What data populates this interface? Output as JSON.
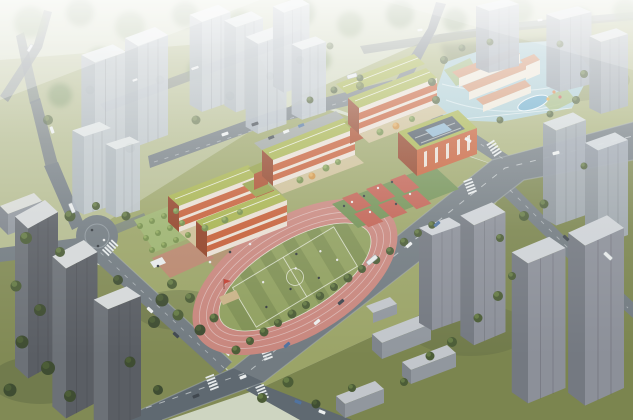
{
  "meta": {
    "title": "Aerial architectural rendering of a school campus surrounded by high-rise towers",
    "description": "Bird's-eye rendering: orange classroom wings with green roofs arranged in a zigzag, a gymnasium with a dark skylit roof, red basketball courts, an oval running track with a striped green pitch, a kindergarten parcel with blue play grounds at the upper right, diagonal roads with vehicles and crosswalks, and hazy grey residential towers around the site.",
    "visible_text": []
  },
  "colors": {
    "grass_haze": "#ccd2b5",
    "grass_pale": "#b4ba8c",
    "grass_base": "#99a262",
    "grass_mid": "#a7ae74",
    "grass_dark": "#7e864f",
    "grass_low": "#788148",
    "shadow_green": "#55613a",
    "road": "#6e777d",
    "road_dark": "#5a646c",
    "road_edge": "#a4abb0",
    "marking": "#e9eced",
    "track": "#c9837a",
    "track_line": "#efe4e1",
    "field_a": "#7d8e4e",
    "field_b": "#8e9d5a",
    "pitch_line": "#eef0e6",
    "roof_green": "#a5b046",
    "roof_green_dk": "#8e9a3b",
    "roof_line": "#f4f6f0",
    "school_orange": "#c6582f",
    "school_orange_dark": "#a84523",
    "school_orange_shade": "#8f3a1e",
    "window_band": "#eadfd2",
    "gym_roof": "#49545f",
    "skylight": "#8cb4cf",
    "court_red": "#c05a4a",
    "court_green": "#6d8d4d",
    "courtyard": "#cdbd92",
    "paving_pink": "#c4786c",
    "parking": "#9ba1a5",
    "sand": "#cbb184",
    "flag_red": "#c0392b",
    "kg_wall": "#efe6d6",
    "kg_roof": "#d2906b",
    "kg_ground": "#a9cedd",
    "kg_green": "#9ab26a",
    "pool": "#62a7c9",
    "slab_roof": "#c2c6cb",
    "slab_face": "#8f949b",
    "slab_end": "#7b8087",
    "white_bldg": "#dadbd6",
    "tower_light": "#bcc3cc",
    "tower_light_side": "#a9b1bb",
    "tower_light_roof": "#e3e7eb",
    "tower_med": "#9ea6b0",
    "tower_med_side": "#8a929c",
    "tower_med_roof": "#d5dade",
    "tower_plum": "#8a8d96",
    "tower_plum_side": "#70747d",
    "tower_plum_roof": "#cfd2d6",
    "tower_dark": "#55585e",
    "tower_dark_side": "#686c72",
    "tower_dark_roof": "#d6d8da",
    "tree": "#46572f",
    "tree_hi": "#61773f",
    "tree_bright": "#6f8a43",
    "tree_bright_hi": "#8fa858",
    "tree_dark": "#38462a",
    "tree_autumn": "#cf8f3e",
    "tree_autumn_hi": "#e2aa5a",
    "car_white": "#eef0f0",
    "car_dark": "#3a4148",
    "car_blue": "#4a6e9e",
    "bus": "#e8eaea",
    "person_light": "#e8e8e8",
    "person_dark": "#2e3338"
  }
}
